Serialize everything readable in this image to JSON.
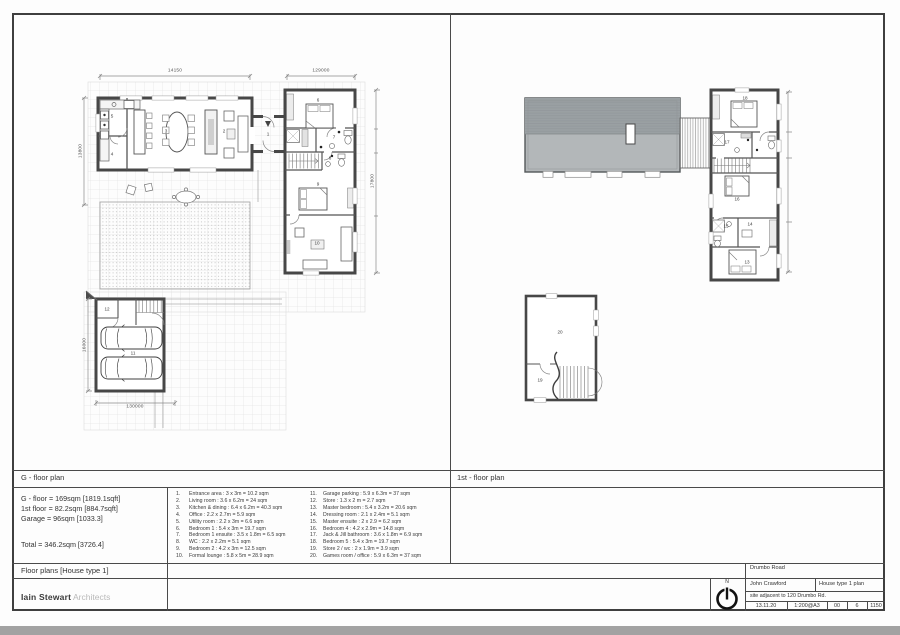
{
  "headers": {
    "g_floor": "G - floor plan",
    "first_floor": "1st - floor plan",
    "project": "Floor plans [House type 1]"
  },
  "summary": {
    "line1": "G - floor = 169sqm [1819.1sqft]",
    "line2": "1st floor = 82.2sqm [884.7sqft]",
    "line3": "Garage = 96sqm [1033.3]",
    "total": "Total = 346.2sqm [3726.4]"
  },
  "schedule": {
    "col1": [
      {
        "n": "1.",
        "t": "Entrance area : 3 x 3m = 10.2 sqm"
      },
      {
        "n": "2.",
        "t": "Living room : 3.6 x 6.2m = 24 sqm"
      },
      {
        "n": "3.",
        "t": "Kitchen & dining : 6.4 x 6.2m = 40.3 sqm"
      },
      {
        "n": "4.",
        "t": "Office : 2.2 x 2.7m = 5.9 sqm"
      },
      {
        "n": "5.",
        "t": "Utility room : 2.2 x 3m = 6.6 sqm"
      },
      {
        "n": "6.",
        "t": "Bedroom 1 : 5.4 x 3m = 19.7 sqm"
      },
      {
        "n": "7.",
        "t": "Bedroom 1 ensuite : 3.5 x 1.8m = 6.5 sqm"
      },
      {
        "n": "8.",
        "t": "WC : 2.2 x 2.2m = 5.1 sqm"
      },
      {
        "n": "9.",
        "t": "Bedroom 2 : 4.2 x 3m = 12.5 sqm"
      },
      {
        "n": "10.",
        "t": "Formal lounge : 5.8 x 5m = 28.9 sqm"
      }
    ],
    "col2": [
      {
        "n": "11.",
        "t": "Garage parking : 5.9 x 6.3m = 37 sqm"
      },
      {
        "n": "12.",
        "t": "Store : 1.3 x 2 m = 2.7 sqm"
      },
      {
        "n": "13.",
        "t": "Master bedroom : 5.4 x 3.2m = 20.6 sqm"
      },
      {
        "n": "14.",
        "t": "Dressing room : 2.1 x 2.4m = 5.1 sqm"
      },
      {
        "n": "15.",
        "t": "Master ensuite : 2 x 2.9 = 6.2 sqm"
      },
      {
        "n": "16.",
        "t": "Bedroom 4 : 4.2 x 2.9m = 14.8 sqm"
      },
      {
        "n": "17.",
        "t": "Jack & Jill bathroom : 3.6 x 1.8m = 6.9 sqm"
      },
      {
        "n": "18.",
        "t": "Bedroom 5 : 5.4 x 3m = 19.7 sqm"
      },
      {
        "n": "19.",
        "t": "Store 2 / wc : 2 x 1.9m = 3.9 sqm"
      },
      {
        "n": "20.",
        "t": "Games room / office : 5.9 x 6.3m = 37 sqm"
      }
    ]
  },
  "titleblock": {
    "road": "Drumbo Road",
    "client": "John Crawford",
    "drawing": "House type 1 plan",
    "site": "site adjacent to 120 Drumbo Rd.",
    "date": "13.11.20",
    "scale": "1:200@A3",
    "rev": "00",
    "num": "6",
    "ref": "1150",
    "north": "N"
  },
  "architect": {
    "name": "Iain Stewart",
    "suffix": "Architects"
  },
  "plans": {
    "g": {
      "dims": {
        "top_left": "14150",
        "top_right": "129000",
        "left": "13800",
        "right": "17800",
        "garage_left": "16000",
        "garage_bottom": "130000"
      },
      "labels": [
        {
          "n": "1",
          "x": 268,
          "y": 134
        },
        {
          "n": "2",
          "x": 224,
          "y": 131
        },
        {
          "n": "3",
          "x": 166,
          "y": 131
        },
        {
          "n": "4",
          "x": 112,
          "y": 154
        },
        {
          "n": "5",
          "x": 112,
          "y": 116
        },
        {
          "n": "6",
          "x": 318,
          "y": 100
        },
        {
          "n": "7",
          "x": 334,
          "y": 137
        },
        {
          "n": "8",
          "x": 330,
          "y": 158
        },
        {
          "n": "9",
          "x": 318,
          "y": 184
        },
        {
          "n": "10",
          "x": 317,
          "y": 243
        },
        {
          "n": "11",
          "x": 133,
          "y": 353
        },
        {
          "n": "12",
          "x": 107,
          "y": 309
        }
      ]
    },
    "first": {
      "labels": [
        {
          "n": "13",
          "x": 747,
          "y": 262
        },
        {
          "n": "14",
          "x": 750,
          "y": 224
        },
        {
          "n": "15",
          "x": 726,
          "y": 226
        },
        {
          "n": "16",
          "x": 737,
          "y": 199
        },
        {
          "n": "17",
          "x": 727,
          "y": 142
        },
        {
          "n": "18",
          "x": 745,
          "y": 98
        },
        {
          "n": "19",
          "x": 540,
          "y": 380
        },
        {
          "n": "20",
          "x": 560,
          "y": 332
        }
      ]
    }
  }
}
